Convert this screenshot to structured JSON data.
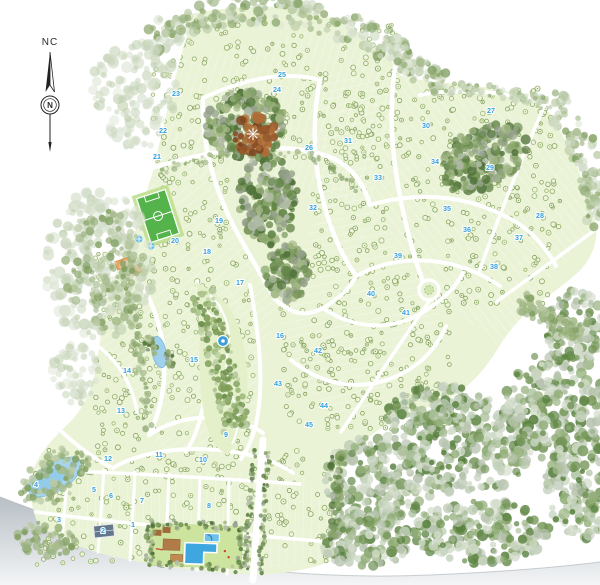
{
  "compass": {
    "region_label": "NC",
    "north_letter": "N"
  },
  "palette": {
    "land": "#eaf3d6",
    "road": "#ffffff",
    "section_number": "#36a0da",
    "water": "#a7d5ef",
    "field_green": "#55b34b",
    "building_orange": "#f2a35e",
    "deck_brown": "#b07b46",
    "clearing_brown": "#9a5a2b",
    "pool_blue": "#3fa7e0",
    "page_shadow": "#b8bfc5"
  },
  "sections": [
    {
      "n": "1",
      "x": 133,
      "y": 527
    },
    {
      "n": "2",
      "x": 103,
      "y": 533
    },
    {
      "n": "3",
      "x": 59,
      "y": 522
    },
    {
      "n": "4",
      "x": 36,
      "y": 487
    },
    {
      "n": "5",
      "x": 94,
      "y": 492
    },
    {
      "n": "6",
      "x": 111,
      "y": 498
    },
    {
      "n": "7",
      "x": 142,
      "y": 503
    },
    {
      "n": "8",
      "x": 209,
      "y": 508
    },
    {
      "n": "9",
      "x": 226,
      "y": 437
    },
    {
      "n": "10",
      "x": 203,
      "y": 462
    },
    {
      "n": "11",
      "x": 159,
      "y": 457
    },
    {
      "n": "12",
      "x": 108,
      "y": 461
    },
    {
      "n": "13",
      "x": 121,
      "y": 413
    },
    {
      "n": "14",
      "x": 127,
      "y": 373
    },
    {
      "n": "15",
      "x": 194,
      "y": 362
    },
    {
      "n": "16",
      "x": 280,
      "y": 338
    },
    {
      "n": "17",
      "x": 240,
      "y": 285
    },
    {
      "n": "18",
      "x": 207,
      "y": 254
    },
    {
      "n": "19",
      "x": 219,
      "y": 223
    },
    {
      "n": "20",
      "x": 175,
      "y": 243
    },
    {
      "n": "21",
      "x": 157,
      "y": 159
    },
    {
      "n": "22",
      "x": 163,
      "y": 133
    },
    {
      "n": "23",
      "x": 176,
      "y": 96
    },
    {
      "n": "24",
      "x": 277,
      "y": 92
    },
    {
      "n": "25",
      "x": 282,
      "y": 77
    },
    {
      "n": "26",
      "x": 309,
      "y": 150
    },
    {
      "n": "27",
      "x": 491,
      "y": 113
    },
    {
      "n": "28",
      "x": 540,
      "y": 218
    },
    {
      "n": "29",
      "x": 490,
      "y": 170
    },
    {
      "n": "30",
      "x": 426,
      "y": 128
    },
    {
      "n": "31",
      "x": 348,
      "y": 143
    },
    {
      "n": "32",
      "x": 313,
      "y": 210
    },
    {
      "n": "33",
      "x": 378,
      "y": 180
    },
    {
      "n": "34",
      "x": 435,
      "y": 164
    },
    {
      "n": "35",
      "x": 447,
      "y": 211
    },
    {
      "n": "36",
      "x": 467,
      "y": 232
    },
    {
      "n": "37",
      "x": 519,
      "y": 240
    },
    {
      "n": "38",
      "x": 494,
      "y": 269
    },
    {
      "n": "39",
      "x": 398,
      "y": 258
    },
    {
      "n": "40",
      "x": 371,
      "y": 296
    },
    {
      "n": "41",
      "x": 406,
      "y": 315
    },
    {
      "n": "42",
      "x": 318,
      "y": 353
    },
    {
      "n": "43",
      "x": 278,
      "y": 386
    },
    {
      "n": "44",
      "x": 324,
      "y": 408
    },
    {
      "n": "45",
      "x": 309,
      "y": 427
    }
  ],
  "amenities": [
    {
      "name": "soccer-field",
      "x": 158,
      "y": 216
    },
    {
      "name": "parking-area",
      "x": 114,
      "y": 226
    },
    {
      "name": "clubhouse-buildings",
      "x": 127,
      "y": 266
    },
    {
      "name": "splash-pools",
      "x": 145,
      "y": 242
    },
    {
      "name": "central-park-fountain",
      "x": 223,
      "y": 341
    },
    {
      "name": "pond",
      "x": 159,
      "y": 352
    },
    {
      "name": "lake",
      "x": 55,
      "y": 477
    },
    {
      "name": "roundabout",
      "x": 429,
      "y": 290
    },
    {
      "name": "forest-clearing-star",
      "x": 253,
      "y": 134
    },
    {
      "name": "pool-complex",
      "x": 195,
      "y": 546
    },
    {
      "name": "slate-roof-building",
      "x": 104,
      "y": 531
    },
    {
      "name": "entrance-boulevard",
      "x": 258,
      "y": 512
    }
  ]
}
